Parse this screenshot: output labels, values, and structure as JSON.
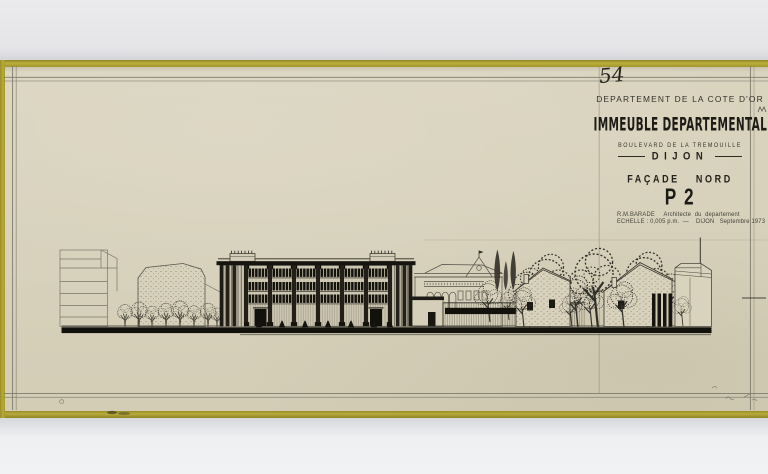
{
  "palette": {
    "background_top": "#e9e9eb",
    "background_bottom": "#eef0f2",
    "tape": "#b3a535",
    "paper": "#d8d2bd",
    "ink": "#23221b",
    "frame_line": "#7e7b6c"
  },
  "sheet": {
    "number": "54",
    "title_block": {
      "department": "DEPARTEMENT DE LA COTE D'OR",
      "project": "IMMEUBLE DEPARTEMENTAL",
      "address": "BOULEVARD DE LA TREMOUILLE",
      "city": "DIJON",
      "view": "FAÇADE NORD",
      "plan_number": "P 2",
      "architect_line": "R.M.BARADE     Architecte  du  departement",
      "scale_line": "ECHELLE : 0,005 p.m.  —    DIJON   Septembre 1973"
    }
  }
}
